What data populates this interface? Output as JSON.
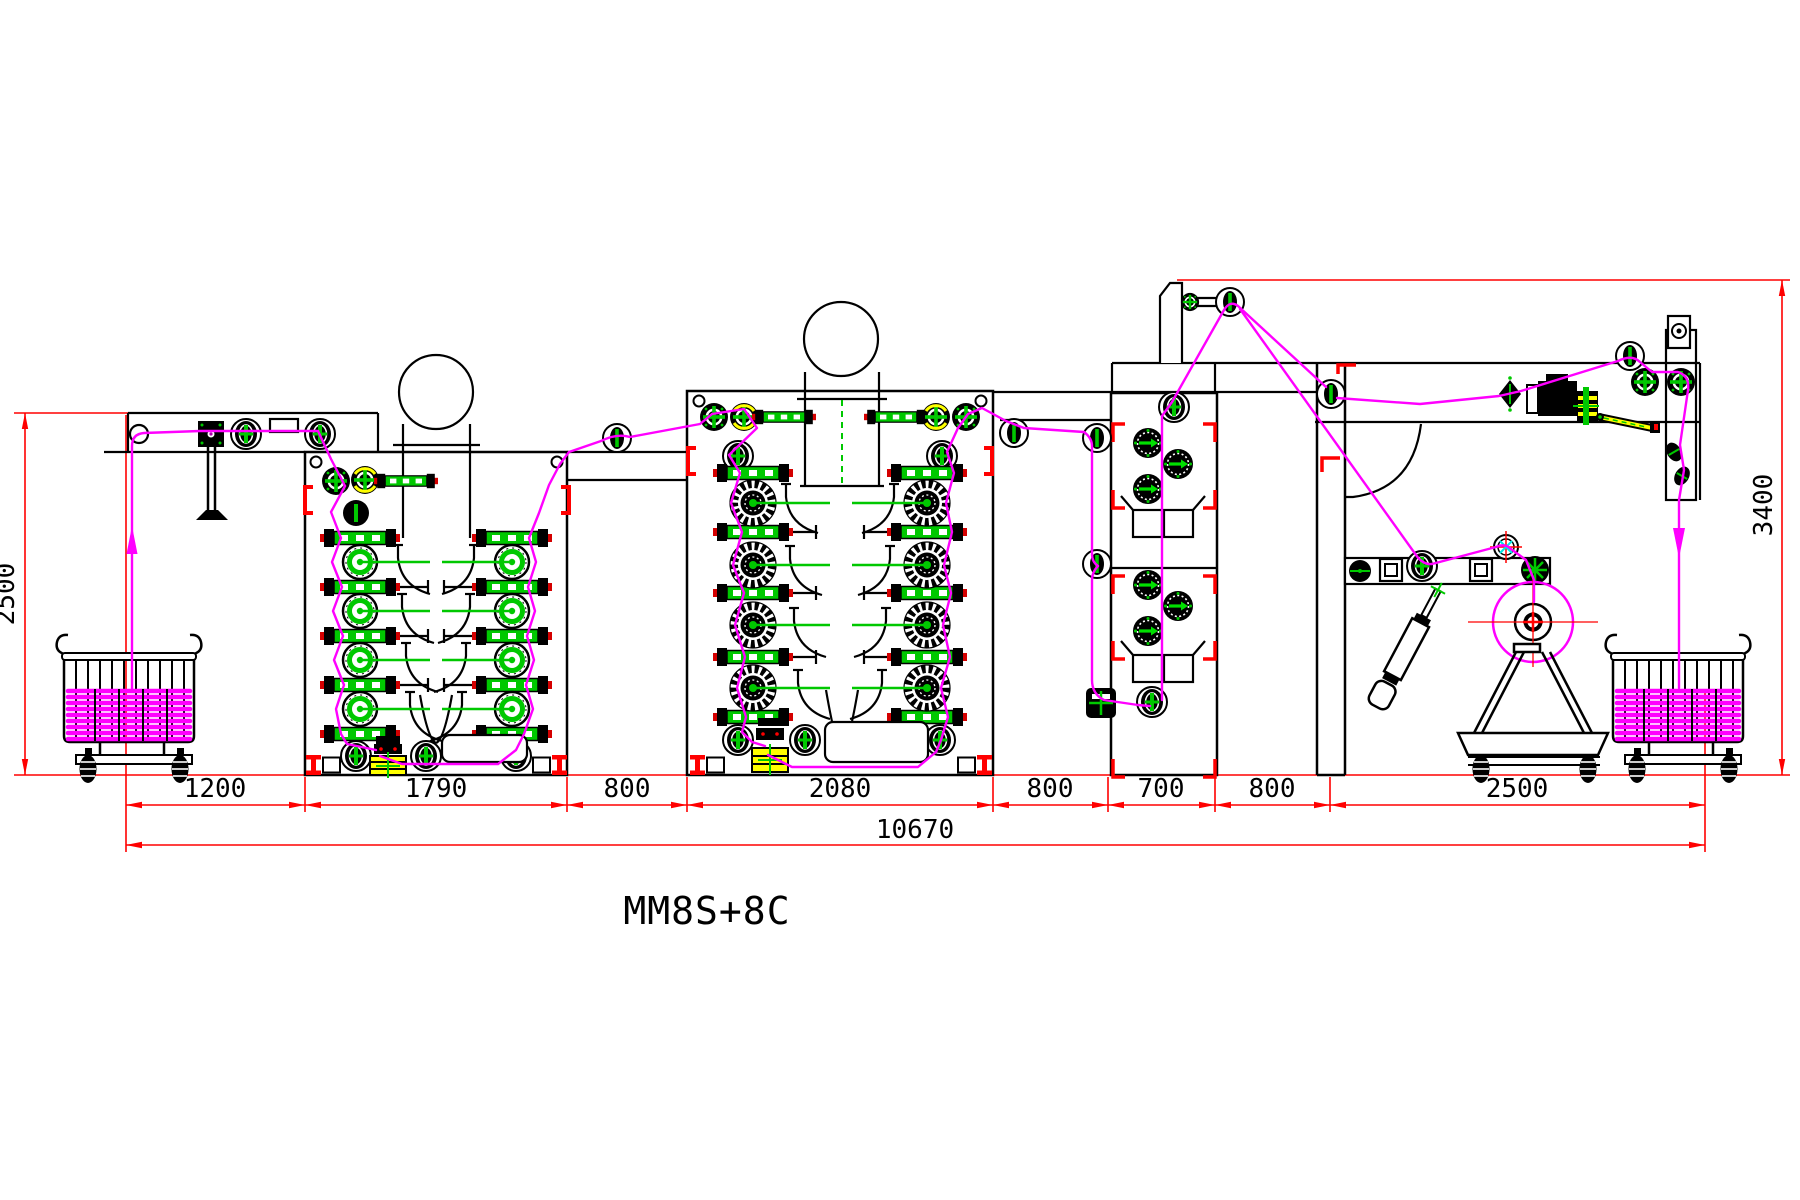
{
  "diagram": {
    "machine_label": "MM8S+8C",
    "bottom_dimensions": {
      "segments": [
        "1200",
        "1790",
        "800",
        "2080",
        "800",
        "700",
        "800",
        "2500"
      ],
      "total": "10670"
    },
    "height_dimensions": {
      "left": "2500",
      "right": "3400"
    },
    "colors": {
      "dimension_lines": "#ff0000",
      "fabric_web_path": "#ff00ff",
      "roller_accent": "#00c800",
      "outline": "#000000",
      "highlight": "#ffff00",
      "background": "#ffffff"
    }
  }
}
